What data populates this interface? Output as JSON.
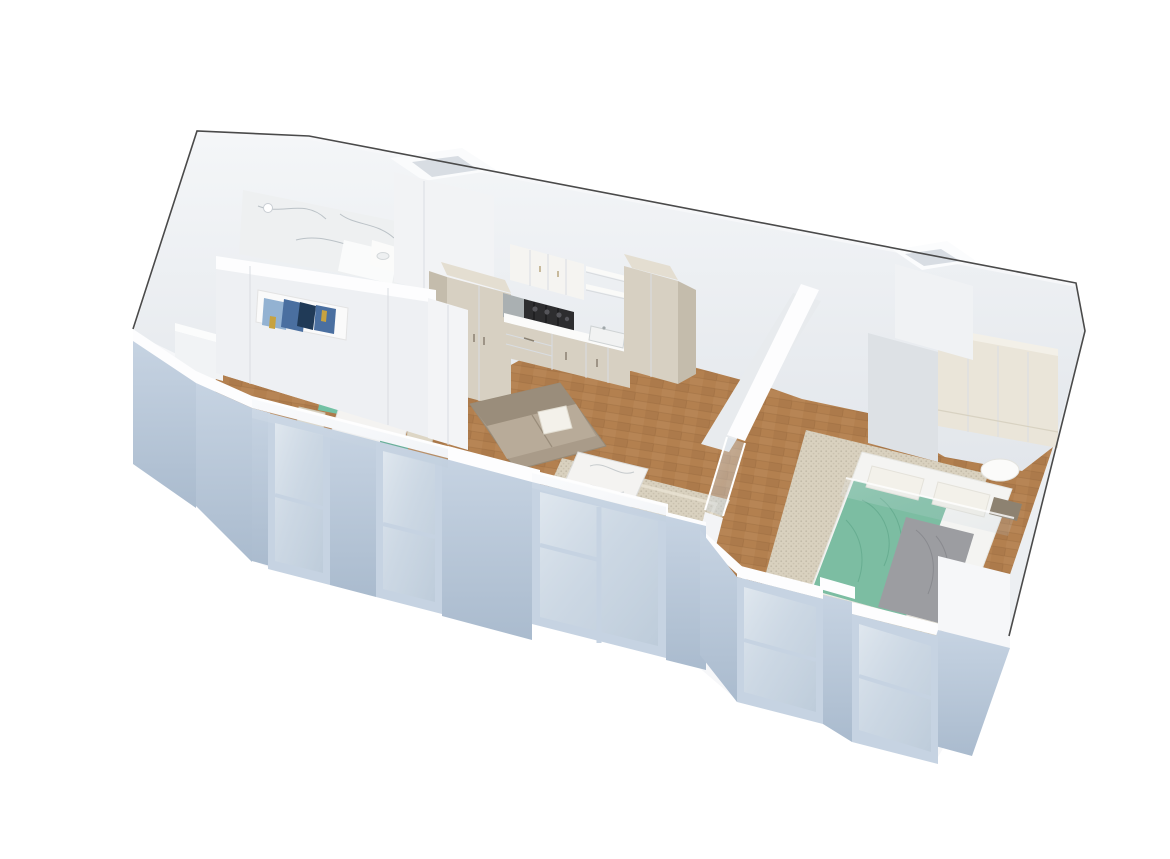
{
  "scene": {
    "kind": "3d-floorplan-cutaway-render",
    "rooms": [
      {
        "name": "bathroom",
        "items": [
          "marble-shower-floor",
          "shower-head",
          "vanity-sink",
          "partition-bench"
        ]
      },
      {
        "name": "kitchen",
        "items": [
          "upper-cabinets",
          "open-shelves",
          "tall-pantry-cabinet",
          "tall-cabinet-right",
          "gas-cooktop",
          "steel-counter-section",
          "countertop",
          "sink",
          "base-cabinets-drawers"
        ]
      },
      {
        "name": "dining-nook",
        "items": [
          "marble-dining-table",
          "teal-chair-back",
          "teal-chair-front",
          "beige-chair-left",
          "beige-chair-right",
          "white-sideboard",
          "abstract-painting"
        ]
      },
      {
        "name": "living-room",
        "items": [
          "taupe-sofa",
          "white-throw-pillow",
          "marble-coffee-table",
          "woven-beige-rug",
          "gray-ottoman"
        ]
      },
      {
        "name": "bedroom",
        "items": [
          "double-bed",
          "teal-blanket",
          "gray-duvet",
          "white-pillows",
          "taupe-pillow",
          "round-nightstand",
          "cream-wardrobe",
          "beige-rug"
        ]
      },
      {
        "name": "shell",
        "items": [
          "cut-wall-outline",
          "ventilation-shaft-bathroom",
          "ventilation-shaft-bedroom",
          "partition-wall-with-glass-door",
          "front-facade-windows",
          "radiators-under-windows",
          "parquet-wood-floor"
        ]
      }
    ]
  },
  "colors": {
    "background": "#ffffff",
    "outline": "#4a4a4a",
    "wall_white": "#f6f7f9",
    "wall_face_top": "#f4f6f8",
    "wall_face_bottom": "#e2e6eb",
    "wall_top_band": "#fdfdfe",
    "facade_blue": "#bfcddd",
    "facade_blue_dark": "#aabbce",
    "window_frame": "#c6d3e2",
    "glass": "#dce5ee",
    "wood_floor": "#b3804f",
    "marble": "#eef0f1",
    "marble_vein": "#9aa4ac",
    "cabinet_beige": "#d7d0c2",
    "cabinet_beige_dark": "#c4bcac",
    "cabinet_beige_top": "#e4ded1",
    "cabinet_white": "#f5f4f1",
    "counter_white": "#fbfbfa",
    "cooktop_black": "#2d2d2f",
    "steel": "#aab0b2",
    "sofa_taupe": "#a99b89",
    "sofa_taupe_dark": "#9a8d7b",
    "sofa_taupe_light": "#b8ab99",
    "pillow_white": "#f3f1ea",
    "rug_beige": "#d9d1bf",
    "table_marble": "#f4f3f1",
    "chair_teal": "#72c1a4",
    "chair_teal_dark": "#57a98c",
    "chair_beige": "#ddd6c5",
    "bed_blanket_teal": "#7cbda2",
    "bed_blanket_teal_dark": "#5fa78a",
    "bed_duvet_gray": "#9c9da1",
    "bed_duvet_dark": "#85868b",
    "bed_white": "#f4f4f2",
    "pillow_taupe": "#8d8271",
    "wardrobe_cream": "#eae5d9",
    "closet_side_gray": "#dde1e5",
    "radiator_gray": "#8f9194",
    "shaft_inner": "#d8dde3",
    "painting_blue": "#4a6fa0",
    "painting_navy": "#203a57",
    "painting_lightblue": "#93b2d2",
    "painting_gold": "#c7a23f"
  }
}
